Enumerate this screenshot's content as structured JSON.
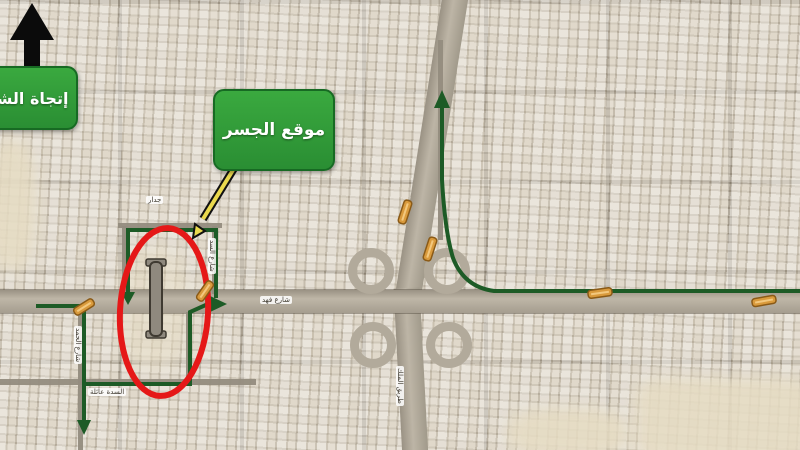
{
  "map": {
    "title_hint": "aerial city map with bridge location annotation",
    "north_label": "إتجاة الشمال",
    "bridge_label": "موقع الجسر",
    "street_labels": {
      "top_street": "جدار",
      "right_street": "شارع السد",
      "left_street": "شارع الحمد",
      "bottom_street": "السدة عائلة",
      "main_road": "شارع فهد",
      "highway": "طريق الملك"
    },
    "colors": {
      "route_green": "#1d5b26",
      "highlight_red": "#e51818",
      "label_green": "#2f9f3e",
      "marker_orange": "#d99a3c",
      "map_sand": "#d4cbbb"
    },
    "icons": {
      "north-arrow-icon": "▲",
      "pointer-arrow-icon": "↙",
      "bridge-symbol-icon": "↕",
      "roadwork-marker-icon": "▬"
    },
    "roadwork_marker_count": 6
  }
}
